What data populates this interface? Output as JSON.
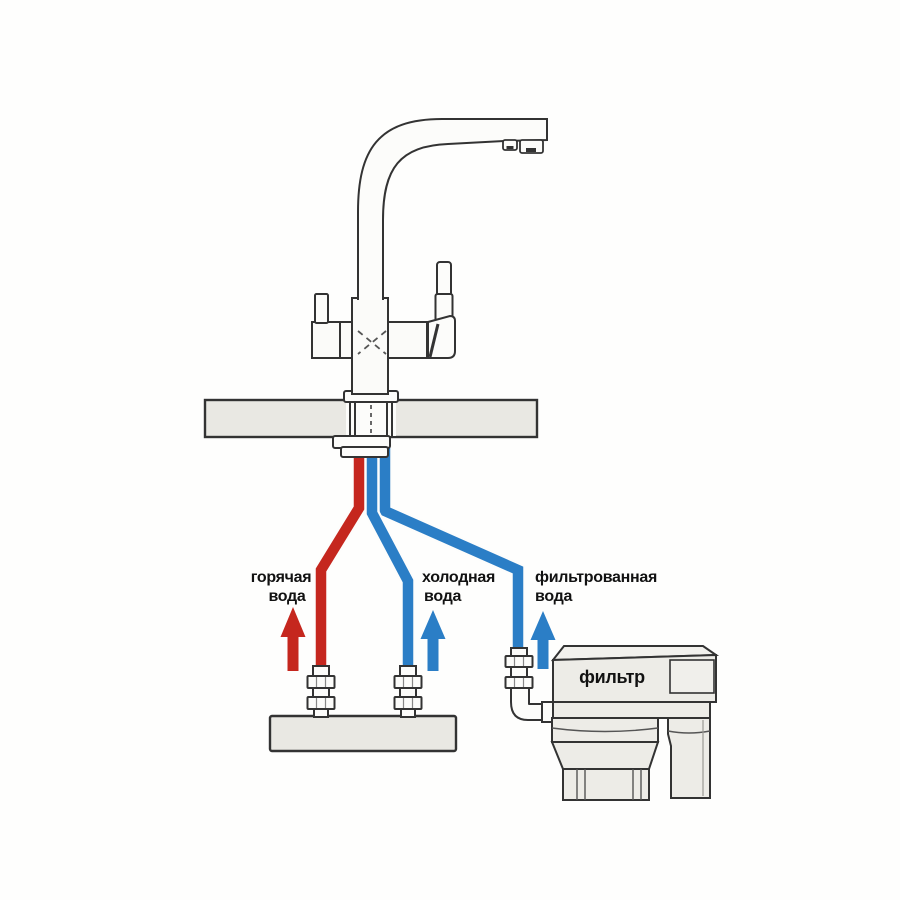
{
  "labels": {
    "hot_water": {
      "line1": "горячая",
      "line2": "вода"
    },
    "cold_water": {
      "line1": "холодная",
      "line2": "вода"
    },
    "filtered_water": {
      "line1": "фильтрованная",
      "line2": "вода"
    },
    "filter_unit": "фильтр"
  },
  "colors": {
    "hot": "#c5271e",
    "cold": "#2b7ec6",
    "filtered": "#2b7ec6"
  }
}
